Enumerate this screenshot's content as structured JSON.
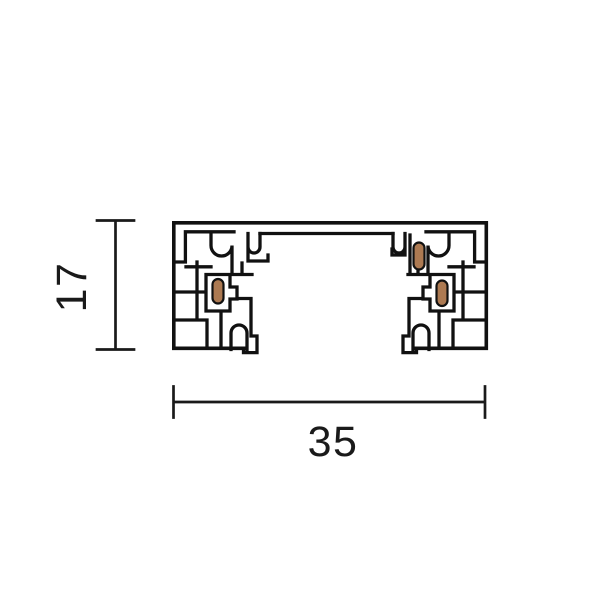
{
  "figure": {
    "type": "technical-cross-section-drawing",
    "subject": "track-profile",
    "dimension_height": {
      "value": "17"
    },
    "dimension_width": {
      "value": "35"
    },
    "conductor_count": 3
  },
  "colors": {
    "line": "#111111",
    "conductor_fill": "#ad7a52",
    "background": "#ffffff"
  }
}
